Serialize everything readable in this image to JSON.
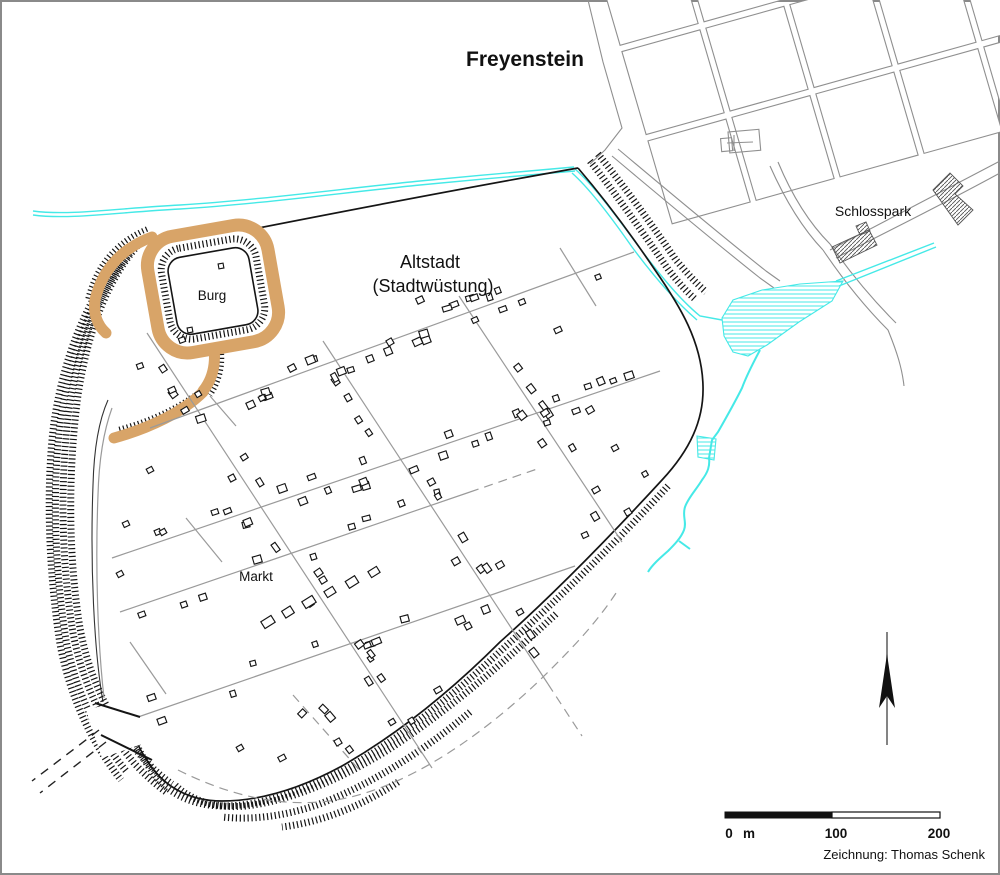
{
  "labels": {
    "title": "Freyenstein",
    "altstadt_line1": "Altstadt",
    "altstadt_line2": "(Stadtwüstung)",
    "burg": "Burg",
    "markt": "Markt",
    "schlosspark": "Schlosspark",
    "credit": "Zeichnung: Thomas Schenk"
  },
  "scalebar": {
    "start": "0",
    "unit": "m",
    "mid": "100",
    "end": "200"
  },
  "colors": {
    "earthwork": "#D8A468",
    "water": "#45E9E7",
    "street": "#9A9A9A",
    "modern": "#8F8F8F",
    "ink": "#151515",
    "frame": "#8A8A8A"
  },
  "map_geometry": {
    "seed": 987654321,
    "modern_blocks": {
      "gx": 592,
      "gy": -40,
      "ax": 0.28,
      "ay": 0.96,
      "stepA": 93,
      "bx": 0.965,
      "by": -0.27,
      "stepB": 87,
      "rows": 3,
      "cols": 5,
      "inset": 4.5
    },
    "modern_roads": [
      "M 588,0 L 603,62 L 622,128 L 605,150 L 590,164",
      "M 612,156 C 662,198 712,240 760,278 L 774,288",
      "M 618,149 C 668,191 718,233 766,271 L 780,281",
      "M 770,166 C 786,202 803,229 823,250",
      "M 778,162 C 793,198 810,224 830,244",
      "M 823,250 C 848,287 870,312 888,330 C 897,352 902,368 904,386",
      "M 830,244 C 856,281 878,305 896,323",
      "M 830,250 C 876,226 926,200 1000,161",
      "M 836,258 C 882,234 932,210 1000,173"
    ],
    "church": {
      "rx": 728,
      "ry": 132,
      "rw": 31,
      "rh": 21,
      "tx": 720,
      "ty": 138,
      "tw": 11,
      "th": 13,
      "cross": [
        "M 727,143 L 753,142",
        "M 734,135 L 734,151"
      ]
    },
    "hatched_buildings": [
      [
        [
          933,
          190
        ],
        [
          950,
          173
        ],
        [
          963,
          186
        ],
        [
          955,
          194
        ],
        [
          973,
          210
        ],
        [
          958,
          225
        ]
      ],
      [
        [
          832,
          247
        ],
        [
          869,
          230
        ],
        [
          877,
          245
        ],
        [
          840,
          263
        ]
      ],
      [
        [
          856,
          226
        ],
        [
          866,
          222
        ],
        [
          870,
          231
        ],
        [
          860,
          235
        ]
      ]
    ],
    "wetlands": [
      [
        [
          722,
          318
        ],
        [
          733,
          300
        ],
        [
          762,
          290
        ],
        [
          800,
          284
        ],
        [
          843,
          281
        ],
        [
          832,
          301
        ],
        [
          799,
          322
        ],
        [
          767,
          345
        ],
        [
          748,
          356
        ],
        [
          733,
          352
        ],
        [
          724,
          336
        ]
      ],
      [
        [
          697,
          436
        ],
        [
          716,
          439
        ],
        [
          714,
          460
        ],
        [
          698,
          457
        ]
      ]
    ],
    "streams_thin": [
      "M 33,211 C 70,216 120,208 180,205 C 260,200 340,189 420,181 C 470,176 530,171 574,167",
      "M 33,215 C 70,220 120,212 180,209 C 260,204 340,193 420,185 C 470,180 530,175 575,171",
      "M 575,169 C 592,184 612,210 636,243 C 656,270 678,298 700,316 L 722,320",
      "M 572,173 C 589,188 609,214 632,247 C 652,274 675,301 697,320",
      "M 836,281 L 934,243",
      "M 839,286 L 936,247"
    ],
    "streams_thick": [
      "M 760,350 C 752,365 746,377 742,388 C 734,404 726,418 718,432 L 712,440 L 709,458 C 710,466 708,472 702,480 C 696,490 688,498 685,507 C 682,516 687,522 684,530 C 681,538 674,545 668,551 C 660,558 652,565 648,572",
      "M 679,541 L 690,549"
    ],
    "boundary": [
      "M 243,231 C 355,209 470,187 578,168",
      "M 578,168 C 602,196 628,230 655,270 C 680,306 702,342 703,386 C 704,420 690,450 662,480 C 616,530 556,592 500,642 C 452,690 398,734 342,766 C 296,791 256,801 222,801 C 187,801 163,785 148,762 C 138,747 132,733 129,719"
    ],
    "boundary_thin": [
      "M 103,702 C 94,650 90,565 93,485 C 94,447 99,420 108,400"
    ],
    "combs": [
      "M 590,161 C 615,193 641,230 668,269 C 677,281 686,291 696,300",
      "M 598,154 C 624,186 650,222 676,260 C 686,272 696,283 706,292",
      "M 668,486 C 622,536 562,596 506,646 C 457,692 404,736 348,768 C 301,793 258,806 224,806 C 190,806 166,792 151,770 C 142,757 136,745 133,733",
      "M 556,614 C 498,668 446,712 388,750 C 336,782 288,801 246,806 C 215,809 190,800 174,784",
      "M 470,712 C 421,753 370,785 317,805 C 282,817 250,820 222,817",
      "M 398,782 C 362,806 322,822 282,827",
      "M 140,243 C 108,278 88,330 78,395 C 68,470 68,555 80,628 C 90,682 112,723 142,757 C 152,768 162,777 172,784",
      "M 130,253 C 99,291 79,343 69,409 C 60,479 61,559 73,633 C 83,685 104,727 134,763 C 144,774 155,784 166,792",
      "M 120,263 C 91,302 71,352 61,417 C 52,482 54,564 66,640 C 76,692 97,736 127,772",
      "M 110,272 C 84,310 64,357 54,422 C 46,484 48,567 60,644 C 70,697 91,742 121,780"
    ],
    "combs_small": [
      "M 147,229 C 116,242 96,266 88,299",
      "M 221,350 C 223,366 219,382 210,395",
      "M 207,386 C 185,405 152,421 117,430"
    ],
    "earth_paths": [
      {
        "d": "M 152,237 C 122,248 102,270 95,300 C 93,313 97,325 106,333",
        "w": 11
      },
      {
        "d": "M 214,348 C 216,366 212,380 203,391",
        "w": 11
      },
      {
        "d": "M 203,392 C 183,412 150,428 114,438",
        "w": 11
      }
    ],
    "ring": {
      "x": 152,
      "y": 230,
      "w": 122,
      "h": 118,
      "rx": 30,
      "rot": -10,
      "cx": 213,
      "cy": 289,
      "sw": 13
    },
    "ring_comb": {
      "x": 165,
      "y": 243,
      "w": 96,
      "h": 92,
      "rx": 22,
      "rot": -10,
      "cx": 213,
      "cy": 289
    },
    "courtyard": {
      "x": 172,
      "y": 252,
      "w": 82,
      "h": 78,
      "rx": 14,
      "rot": -10,
      "cx": 213,
      "cy": 291
    },
    "court_squares": [
      [
        221,
        266,
        5,
        5,
        -10
      ],
      [
        190,
        330,
        5,
        5,
        -10
      ]
    ],
    "streets": [
      "M 150,428 L 634,252",
      "M 112,558 L 660,371",
      "M 120,612 L 470,492",
      "M 112,726 L 575,566",
      "M 147,333 L 432,768",
      "M 323,341 L 548,684",
      "M 459,296 L 622,542",
      "M 104,698 C 98,645 95,570 98,495 C 99,458 104,430 112,408",
      "M 210,396 L 236,426",
      "M 560,248 L 596,306",
      "M 130,642 L 166,694",
      "M 186,518 L 222,562"
    ],
    "streets_dashed": [
      "M 178,770 C 240,801 302,812 362,794 C 430,774 502,720 560,660 C 584,636 604,612 618,590",
      "M 293,695 L 362,773",
      "M 548,684 L 582,736",
      "M 470,492 L 540,468"
    ],
    "gate": {
      "mask": [
        [
          86,
          710
        ],
        [
          132,
          698
        ],
        [
          148,
          742
        ],
        [
          102,
          758
        ]
      ],
      "lines": [
        "M 95,703 L 140,717",
        "M 101,735 L 152,760"
      ],
      "dashed_road": [
        "M 99,730 L 32,781",
        "M 106,742 L 40,793"
      ]
    },
    "house_streets": [
      [
        150,
        428,
        634,
        252,
        22
      ],
      [
        112,
        558,
        660,
        371,
        26
      ],
      [
        120,
        612,
        470,
        492,
        9
      ],
      [
        112,
        726,
        575,
        566,
        11
      ],
      [
        147,
        333,
        432,
        768,
        16
      ],
      [
        323,
        341,
        548,
        684,
        13
      ],
      [
        459,
        296,
        622,
        542,
        9
      ],
      [
        293,
        695,
        362,
        773,
        4
      ]
    ],
    "house_scatter": [
      [
        420,
        300,
        7,
        6,
        -25
      ],
      [
        475,
        320,
        6,
        5,
        -25
      ],
      [
        522,
        302,
        6,
        5,
        -22
      ],
      [
        390,
        342,
        6,
        6,
        -30
      ],
      [
        558,
        330,
        7,
        5,
        -25
      ],
      [
        590,
        410,
        7,
        6,
        -30
      ],
      [
        615,
        448,
        6,
        5,
        -28
      ],
      [
        596,
        490,
        7,
        5,
        -30
      ],
      [
        628,
        512,
        6,
        6,
        -30
      ],
      [
        585,
        535,
        6,
        5,
        -25
      ],
      [
        645,
        474,
        5,
        5,
        -30
      ],
      [
        500,
        565,
        7,
        6,
        -30
      ],
      [
        520,
        612,
        6,
        5,
        -30
      ],
      [
        468,
        626,
        6,
        6,
        -28
      ],
      [
        438,
        690,
        7,
        5,
        -30
      ],
      [
        392,
        722,
        6,
        5,
        -32
      ],
      [
        338,
        742,
        6,
        6,
        -30
      ],
      [
        282,
        758,
        7,
        5,
        -28
      ],
      [
        240,
        748,
        6,
        5,
        -30
      ],
      [
        140,
        366,
        6,
        5,
        -20
      ],
      [
        172,
        390,
        7,
        5,
        -25
      ],
      [
        150,
        470,
        6,
        5,
        -28
      ],
      [
        232,
        478,
        6,
        6,
        -28
      ],
      [
        126,
        524,
        6,
        5,
        -25
      ],
      [
        163,
        532,
        6,
        5,
        -30
      ],
      [
        120,
        574,
        6,
        5,
        -28
      ],
      [
        268,
        622,
        12,
        8,
        -32
      ],
      [
        288,
        612,
        10,
        8,
        -32
      ],
      [
        309,
        602,
        12,
        8,
        -32
      ],
      [
        330,
        592,
        10,
        7,
        -32
      ],
      [
        352,
        582,
        11,
        8,
        -32
      ],
      [
        374,
        572,
        10,
        7,
        -32
      ],
      [
        292,
        368,
        7,
        6,
        -28
      ],
      [
        262,
        398,
        6,
        5,
        -28
      ],
      [
        182,
        340,
        6,
        5,
        -20
      ]
    ],
    "scalebar": {
      "x": 725,
      "y": 812,
      "half": 107,
      "h": 6
    },
    "north_arrow": {
      "line": "M 887,632 L 887,745",
      "head": "887,654 879,708 887,696 895,708"
    }
  }
}
